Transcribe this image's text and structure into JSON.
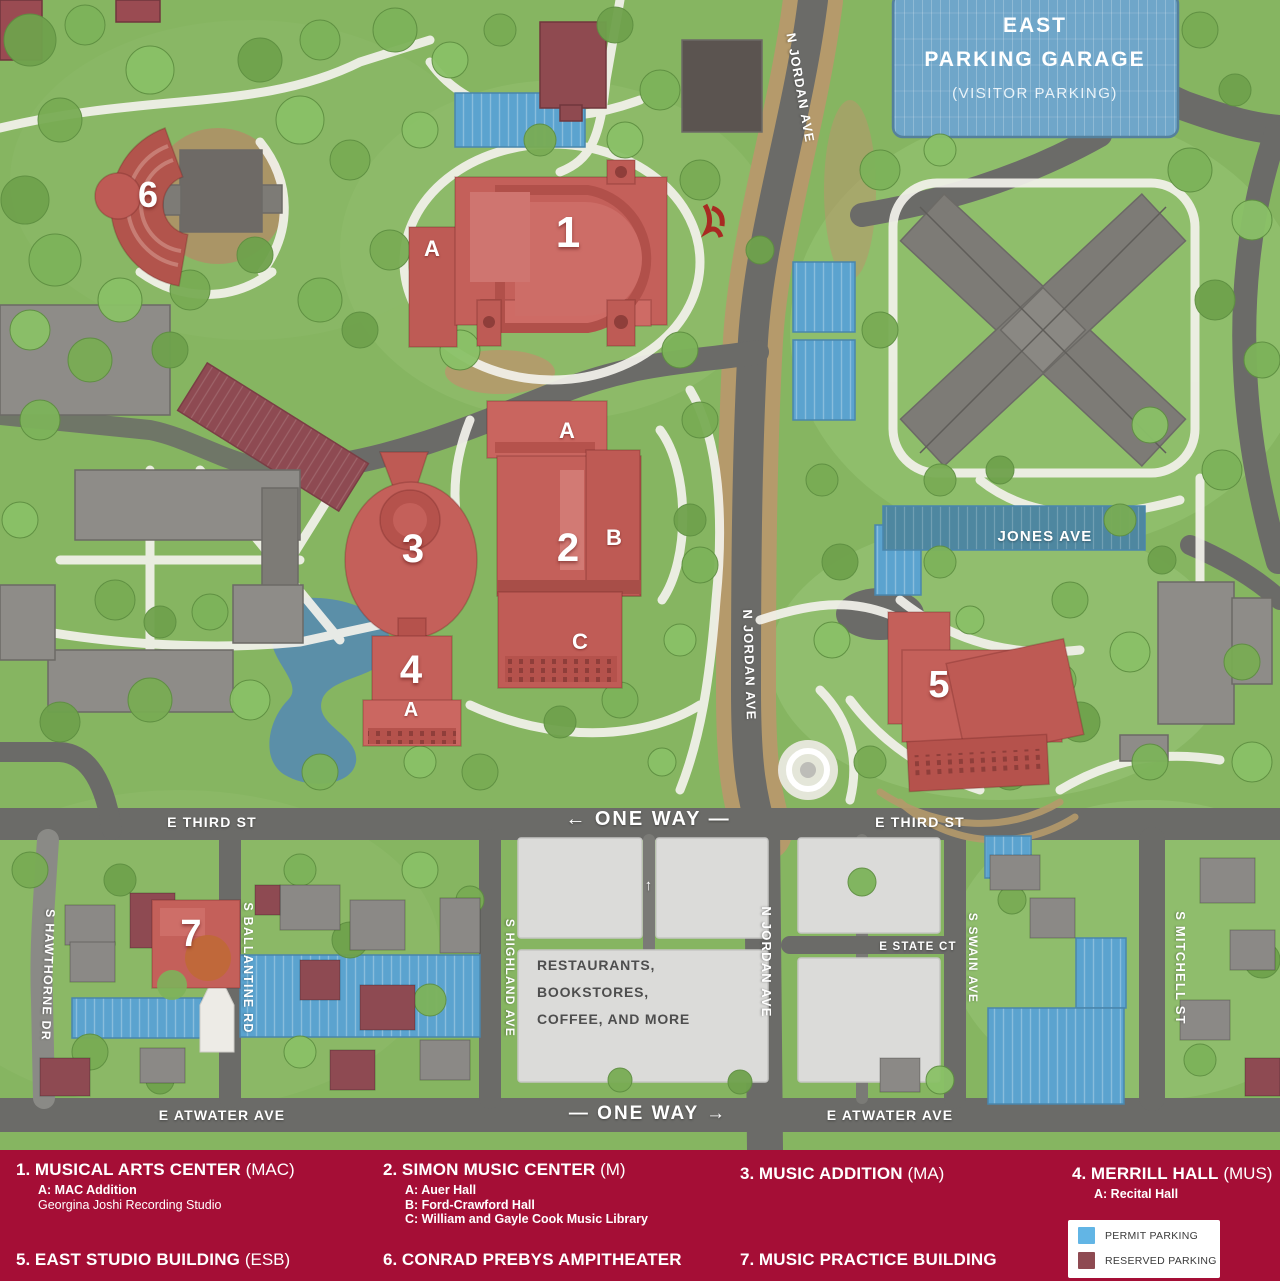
{
  "map": {
    "garage": {
      "line1": "EAST",
      "line2": "PARKING GARAGE",
      "line3": "(VISITOR PARKING)"
    },
    "streets": {
      "n_jordan_top": "N JORDAN AVE",
      "n_jordan_mid": "N JORDAN AVE",
      "n_jordan_bottom": "N JORDAN AVE",
      "jones": "JONES AVE",
      "e_third_left": "E THIRD ST",
      "e_third_right": "E THIRD ST",
      "e_state": "E STATE CT",
      "s_swain": "S SWAIN AVE",
      "s_mitchell": "S MITCHELL ST",
      "s_highland": "S HIGHLAND AVE",
      "s_ballantine": "S BALLANTINE RD",
      "s_hawthorne": "S HAWTHORNE DR",
      "e_atwater_left": "E ATWATER AVE",
      "e_atwater_right": "E ATWATER AVE",
      "one_way_west": "← ONE WAY —",
      "one_way_east": "— ONE WAY →",
      "lot_arrow": "↑"
    },
    "district_label": {
      "line1": "RESTAURANTS,",
      "line2": "BOOKSTORES,",
      "line3": "COFFEE, AND MORE"
    },
    "markers": {
      "b1": "1",
      "b1a": "A",
      "b2": "2",
      "b2a": "A",
      "b2b": "B",
      "b2c": "C",
      "b3": "3",
      "b4": "4",
      "b4a": "A",
      "b5": "5",
      "b6": "6",
      "b7": "7"
    }
  },
  "legend": {
    "entries": [
      {
        "num": "1.",
        "name": "MUSICAL ARTS CENTER",
        "abbr": "(MAC)",
        "subs": [
          "A: MAC Addition",
          "Georgina Joshi Recording Studio"
        ]
      },
      {
        "num": "2.",
        "name": "SIMON MUSIC CENTER",
        "abbr": "(M)",
        "subs": [
          "A: Auer Hall",
          "B: Ford-Crawford Hall",
          "C: William and Gayle Cook Music Library"
        ]
      },
      {
        "num": "3.",
        "name": "MUSIC ADDITION",
        "abbr": "(MA)",
        "subs": []
      },
      {
        "num": "4.",
        "name": "MERRILL HALL",
        "abbr": "(MUS)",
        "subs": [
          "A: Recital Hall"
        ]
      },
      {
        "num": "5.",
        "name": "EAST STUDIO BUILDING",
        "abbr": "(ESB)",
        "subs": []
      },
      {
        "num": "6.",
        "name": "CONRAD PREBYS AMPITHEATER",
        "abbr": "",
        "subs": []
      },
      {
        "num": "7.",
        "name": "MUSIC PRACTICE BUILDING",
        "abbr": "",
        "subs": []
      }
    ],
    "key": {
      "permit": "PERMIT PARKING",
      "reserved": "RESERVED PARKING"
    }
  },
  "colors": {
    "legend_bar": "#A50E36",
    "permit_blue": "#62B5E5",
    "reserved_maroon": "#8E4A52",
    "music_building_red": "#C4605A",
    "garage_blue": "#6FA6C9",
    "jones_blue": "#4E87A0"
  }
}
